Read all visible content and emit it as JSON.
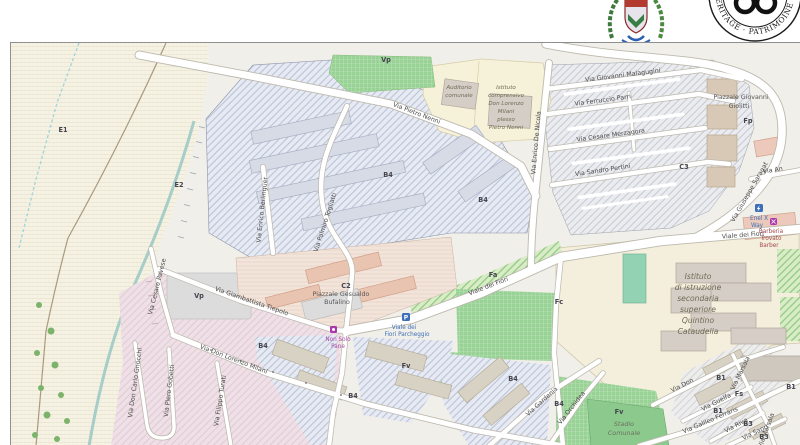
{
  "header": {
    "emblem_ring_text": "HERITAGE · PATRIMOINE M",
    "logos": {
      "coat_of_arms": "municipal coat of arms",
      "emblem": "world heritage circular emblem"
    }
  },
  "palette": {
    "farmland": "#f6f3e4",
    "urban_land": "#f1efe9",
    "zone_hatch_fill": "#e7eaf2",
    "zone_hatch_line": "#b9c3d8",
    "residential_pink": "#efdfe6",
    "green_area": "#98d295",
    "school_yellow": "#f4efdc",
    "building_grey": "#d5cec6",
    "road_white": "#ffffff",
    "water_teal": "#a6cdc7",
    "poi_shop_magenta": "#ac39ac",
    "poi_blue": "#3d6fb8"
  },
  "map": {
    "zone_labels": [
      "E1",
      "E2",
      "Vp",
      "Vp",
      "B4",
      "B4",
      "B4",
      "B4",
      "B4",
      "B4",
      "C3",
      "C2",
      "Fp",
      "Fc",
      "Fa",
      "Fv",
      "Fv",
      "Fs",
      "B1",
      "B1",
      "B1",
      "B3",
      "B3"
    ],
    "streets": [
      "Via Giovanni Malagugini",
      "Via Ferruccio Parri",
      "Via Cesare Merzagora",
      "Via Sandro Pertini",
      "Via Enrico De Nicola",
      "Via Pietro Nenni",
      "Via Enrico Berlinguer",
      "Via Palmiro Togliatti",
      "Via Giambattista Tiepolo",
      "Via Cesare Pavese",
      "Via Don Lorenzo Milani",
      "Via Don Carlo Gnocchi",
      "Via Piero Gobetti",
      "Via Filippo Turati",
      "Viale dei Fiori",
      "Via Giuseppe Saragat",
      "Via An",
      "Via Gardenia",
      "Via Orchidea",
      "Via Galileo Ferraris",
      "Via Don",
      "Via Guelfa",
      "Via Riva",
      "Via Sapri",
      "Via Marsala"
    ],
    "places": {
      "piazzale_giolitti": {
        "lines": [
          "Piazzale Giovanni",
          "Giolitti"
        ]
      },
      "piazzale_bufalino": {
        "lines": [
          "Piazzale Gesualdo",
          "Bufalino"
        ]
      },
      "istituto_cataudella": {
        "lines": [
          "Istituto",
          "di istruzione",
          "secondaria",
          "superiore",
          "Quintino",
          "Cataudella"
        ]
      },
      "istituto_milani": {
        "lines": [
          "Istituto",
          "comprensivo",
          "Don Lorenzo",
          "Milani",
          "plesso",
          "Pietro Nenni"
        ]
      },
      "auditorio": {
        "lines": [
          "Auditorio",
          "comunale"
        ]
      },
      "stadio": {
        "lines": [
          "Stadio",
          "Comunale"
        ]
      }
    },
    "pois": {
      "bakery": {
        "lines": [
          "Non Solo",
          "Pane"
        ]
      },
      "parking": {
        "icon_glyph": "P",
        "lines": [
          "Viale dei",
          "Fiori Parcheggio"
        ]
      },
      "charging": {
        "lines": [
          "Enel X",
          "Way"
        ]
      },
      "barber": {
        "lines": [
          "Barberia",
          "Trovato",
          "Barber"
        ]
      }
    }
  }
}
